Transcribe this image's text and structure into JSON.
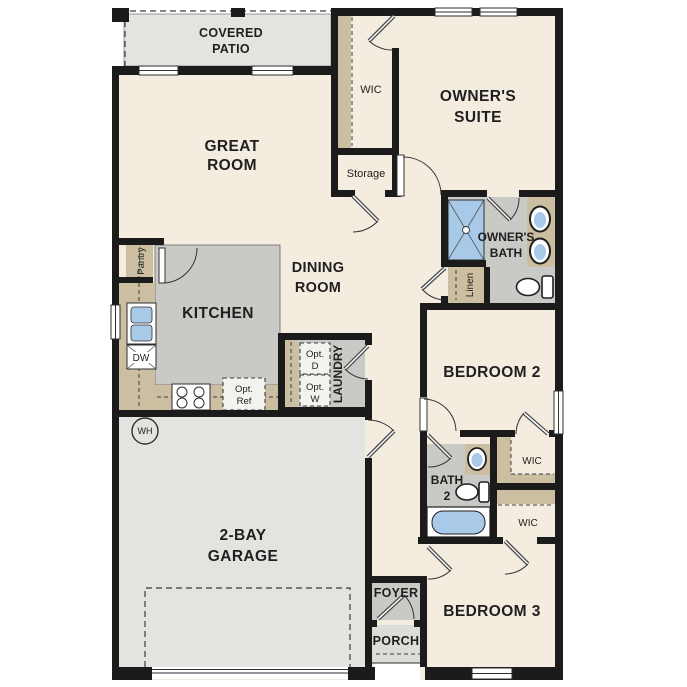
{
  "colors": {
    "wall": "#1b1b1b",
    "floor_cream": "#f3ecdf",
    "floor_gray": "#c9c9c6",
    "floor_lightgray": "#e3e3e0",
    "porch_gray": "#dcdcd8",
    "casework_tan": "#ccbea1",
    "fixture_blue": "#a8c9e8"
  },
  "rooms": {
    "covered_patio": {
      "line1": "COVERED",
      "line2": "PATIO"
    },
    "great_room": {
      "line1": "GREAT",
      "line2": "ROOM"
    },
    "wic_owner": {
      "label": "WIC"
    },
    "storage": {
      "label": "Storage"
    },
    "owners_suite": {
      "line1": "OWNER'S",
      "line2": "SUITE"
    },
    "owners_bath": {
      "line1": "OWNER'S",
      "line2": "BATH"
    },
    "linen": {
      "label": "Linen"
    },
    "pantry": {
      "label": "Pantry"
    },
    "kitchen": {
      "label": "KITCHEN"
    },
    "dining_room": {
      "line1": "DINING",
      "line2": "ROOM"
    },
    "laundry": {
      "label": "LAUNDRY"
    },
    "bedroom2": {
      "label": "BEDROOM 2"
    },
    "bath2": {
      "line1": "BATH",
      "line2": "2"
    },
    "wic_bedroom2": {
      "label": "WIC"
    },
    "wic_bedroom3": {
      "label": "WIC"
    },
    "garage": {
      "line1": "2-BAY",
      "line2": "GARAGE"
    },
    "foyer": {
      "label": "FOYER"
    },
    "porch": {
      "label": "PORCH"
    },
    "bedroom3": {
      "label": "BEDROOM 3"
    }
  },
  "fixtures": {
    "water_heater": {
      "label": "WH"
    },
    "dishwasher": {
      "label": "DW"
    },
    "opt_dryer": {
      "line1": "Opt.",
      "line2": "D"
    },
    "opt_washer": {
      "line1": "Opt.",
      "line2": "W"
    },
    "opt_refrigerator": {
      "line1": "Opt.",
      "line2": "Ref"
    }
  }
}
